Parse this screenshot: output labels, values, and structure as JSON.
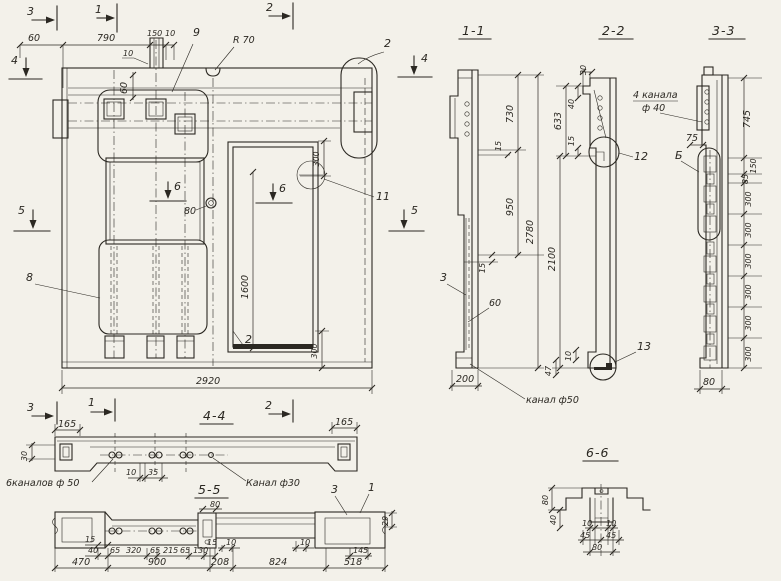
{
  "colors": {
    "paper": "#f3f1ea",
    "ink": "#2b2822"
  },
  "main": {
    "markers": {
      "top3": "3",
      "top1": "1",
      "top2": "2",
      "left4": "4",
      "left5": "5",
      "right4": "4",
      "right5": "5",
      "six_left": "6",
      "six_right": "6"
    },
    "dims": {
      "d60": "60",
      "d790": "790",
      "d150": "150",
      "d10": "10",
      "d10_leader": "10",
      "d60v": "60",
      "r70": "R 70",
      "d300top": "300",
      "d300bot": "300",
      "d1600": "1600",
      "d80": "80",
      "d2920": "2920"
    },
    "parts": {
      "p9": "9",
      "p2top": "2",
      "p11": "11",
      "p8": "8",
      "p2door": "2"
    }
  },
  "s11": {
    "title": "1-1",
    "p3": "3",
    "d730": "730",
    "d15a": "15",
    "d950": "950",
    "d15b": "15",
    "d2780": "2780",
    "d60": "60",
    "d200": "200",
    "kanal": "канал ф50"
  },
  "s22": {
    "title": "2-2",
    "d30": "30",
    "d40": "40",
    "d633": "633",
    "d15": "15",
    "d2100": "2100",
    "d10": "10",
    "d47": "47",
    "p12": "12",
    "p13": "13"
  },
  "s33": {
    "title": "3-3",
    "kanala1": "4 канала",
    "kanala2": "ф 40",
    "d75": "75",
    "b": "Б",
    "d745": "745",
    "d150": "150",
    "d85": "85",
    "d300s": [
      "300",
      "300",
      "300",
      "300",
      "300",
      "300"
    ],
    "d80": "80"
  },
  "s44": {
    "title": "4-4",
    "m3": "3",
    "m1": "1",
    "m2": "2",
    "d165l": "165",
    "d165r": "165",
    "d30": "30",
    "d10": "10",
    "d35": "35",
    "kanalov": "6каналов ф 50",
    "kanal30": "Канал ф30"
  },
  "s55": {
    "title": "5-5",
    "d80": "80",
    "row1": [
      "15",
      "40",
      "65",
      "320",
      "65",
      "215",
      "65",
      "130",
      "15",
      "10",
      "10",
      "145"
    ],
    "d29": "29",
    "row2": [
      "470",
      "900",
      "208",
      "824",
      "518"
    ],
    "p3": "3",
    "p1": "1"
  },
  "s66": {
    "title": "6-6",
    "d80l": "80",
    "d40": "40",
    "d10a": "10",
    "d10b": "10",
    "d45a": "45",
    "d45b": "45",
    "d80b": "80"
  }
}
